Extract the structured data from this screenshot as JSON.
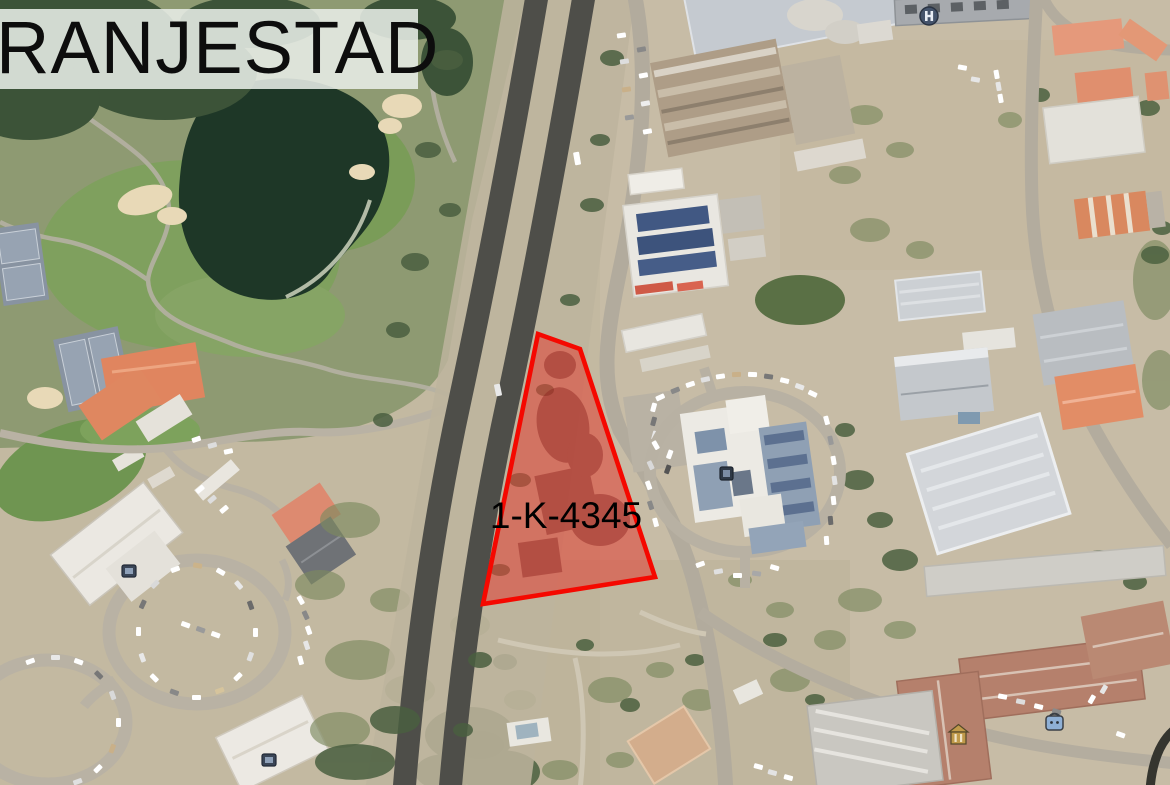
{
  "banner": {
    "title": "RANJESTAD"
  },
  "parcel": {
    "label": "1-K-4345"
  },
  "theme": {
    "banner_bg": "rgba(233,238,232,0.87)",
    "banner_text": "#0d0d0d",
    "parcel_fill": "#e04437",
    "parcel_stroke": "#f50800",
    "label_text": "#000000"
  },
  "map": {
    "type": "satellite-aerial",
    "area": "Oranjestad, Aruba",
    "features": {
      "golf_pond_color": "#1e3727",
      "golf_green_color": "#7fa05e",
      "road_dark_color": "#4e4e49",
      "road_light_color": "#b2ab9d",
      "terracotta_roof_color": "#b5806c",
      "orange_roof_color": "#e08a66",
      "solar_roof_color": "#415883"
    },
    "poi_icons": [
      {
        "name": "circle-h-icon"
      },
      {
        "name": "lodging-icon"
      },
      {
        "name": "lodging-icon-2"
      },
      {
        "name": "building-marker-icon"
      },
      {
        "name": "shopping-bag-icon"
      },
      {
        "name": "landmark-icon"
      }
    ]
  }
}
